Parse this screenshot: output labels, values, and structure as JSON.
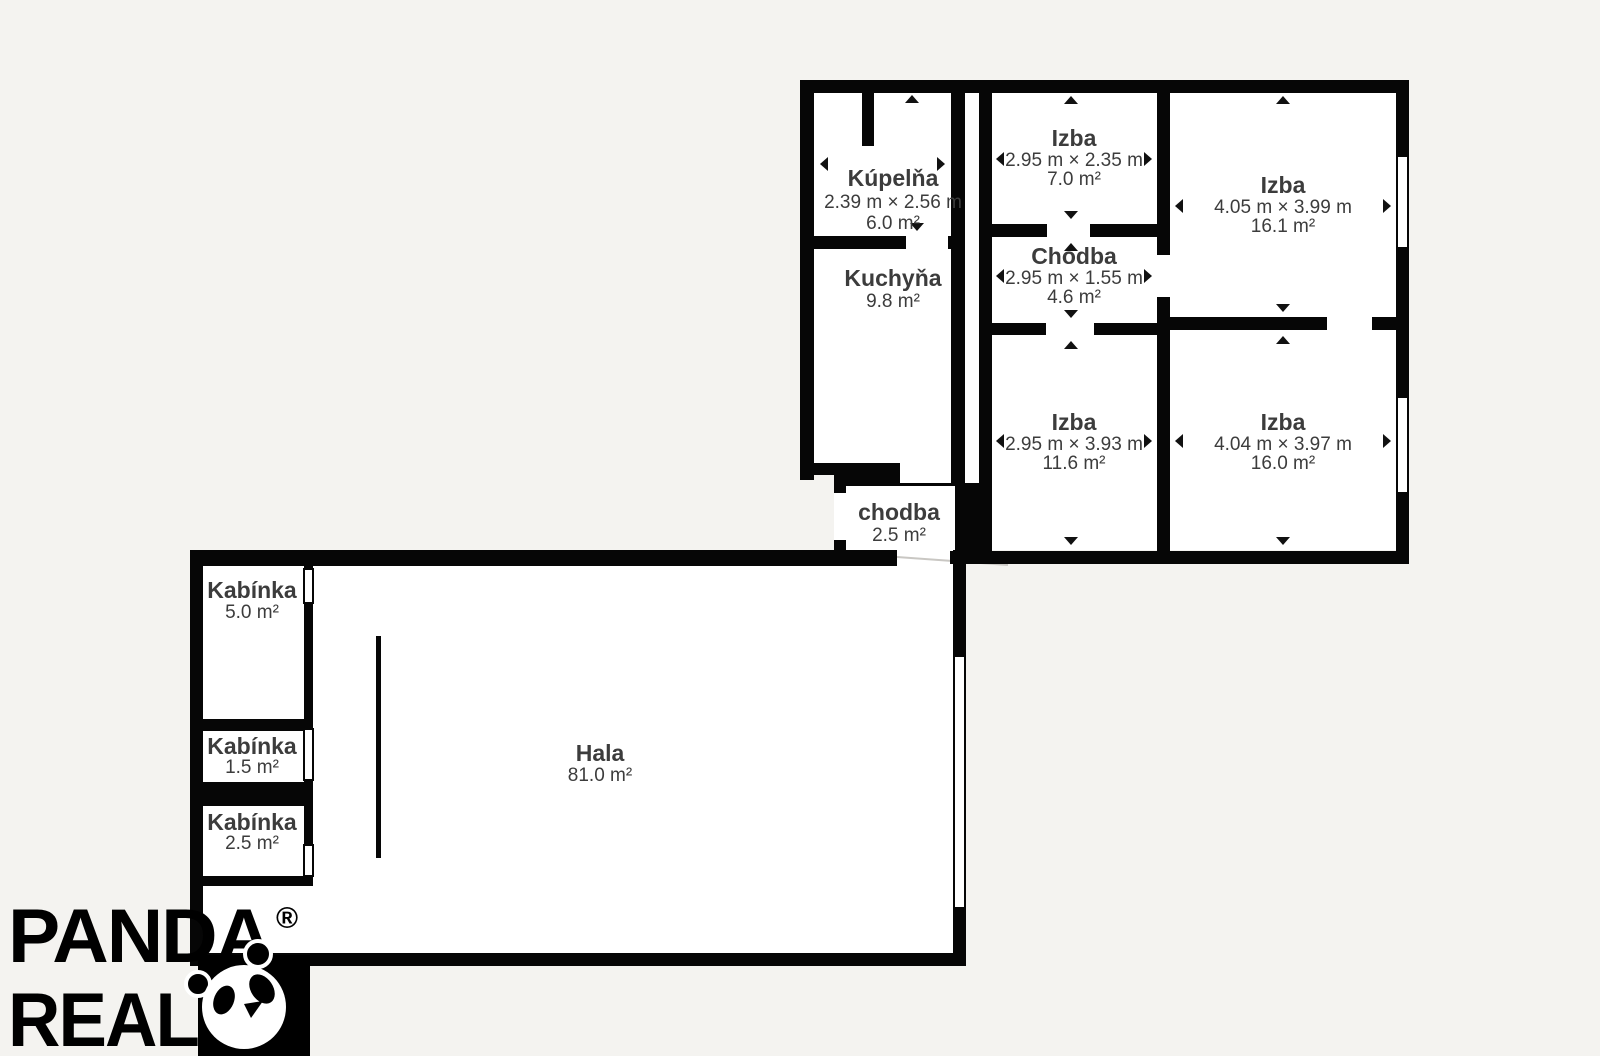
{
  "meta": {
    "background_color": "#f4f3f0",
    "wall_color": "#060606",
    "floor_color": "#ffffff",
    "label_color": "#3c3c3c"
  },
  "rooms": [
    {
      "id": "kupelna",
      "name": "Kúpelňa",
      "dims": "2.39 m × 2.56 m",
      "area": "6.0 m²"
    },
    {
      "id": "izba-7",
      "name": "Izba",
      "dims": "2.95 m × 2.35 m",
      "area": "7.0 m²"
    },
    {
      "id": "izba-16-1",
      "name": "Izba",
      "dims": "4.05 m × 3.99 m",
      "area": "16.1 m²"
    },
    {
      "id": "chodba-4-6",
      "name": "Chodba",
      "dims": "2.95 m × 1.55 m",
      "area": "4.6 m²"
    },
    {
      "id": "kuchyna",
      "name": "Kuchyňa",
      "area": "9.8 m²"
    },
    {
      "id": "izba-11-6",
      "name": "Izba",
      "dims": "2.95 m × 3.93 m",
      "area": "11.6 m²"
    },
    {
      "id": "izba-16-0",
      "name": "Izba",
      "dims": "4.04 m × 3.97 m",
      "area": "16.0 m²"
    },
    {
      "id": "chodba-2-5",
      "name": "chodba",
      "area": "2.5 m²"
    },
    {
      "id": "kabinka-5-0",
      "name": "Kabínka",
      "area": "5.0 m²"
    },
    {
      "id": "kabinka-1-5",
      "name": "Kabínka",
      "area": "1.5 m²"
    },
    {
      "id": "kabinka-2-5",
      "name": "Kabínka",
      "area": "2.5 m²"
    },
    {
      "id": "hala",
      "name": "Hala",
      "area": "81.0 m²"
    }
  ],
  "branding": {
    "company_line1": "PANDA",
    "company_line2": "REAL",
    "registered_mark": "®",
    "logo_icon": "panda-icon"
  }
}
